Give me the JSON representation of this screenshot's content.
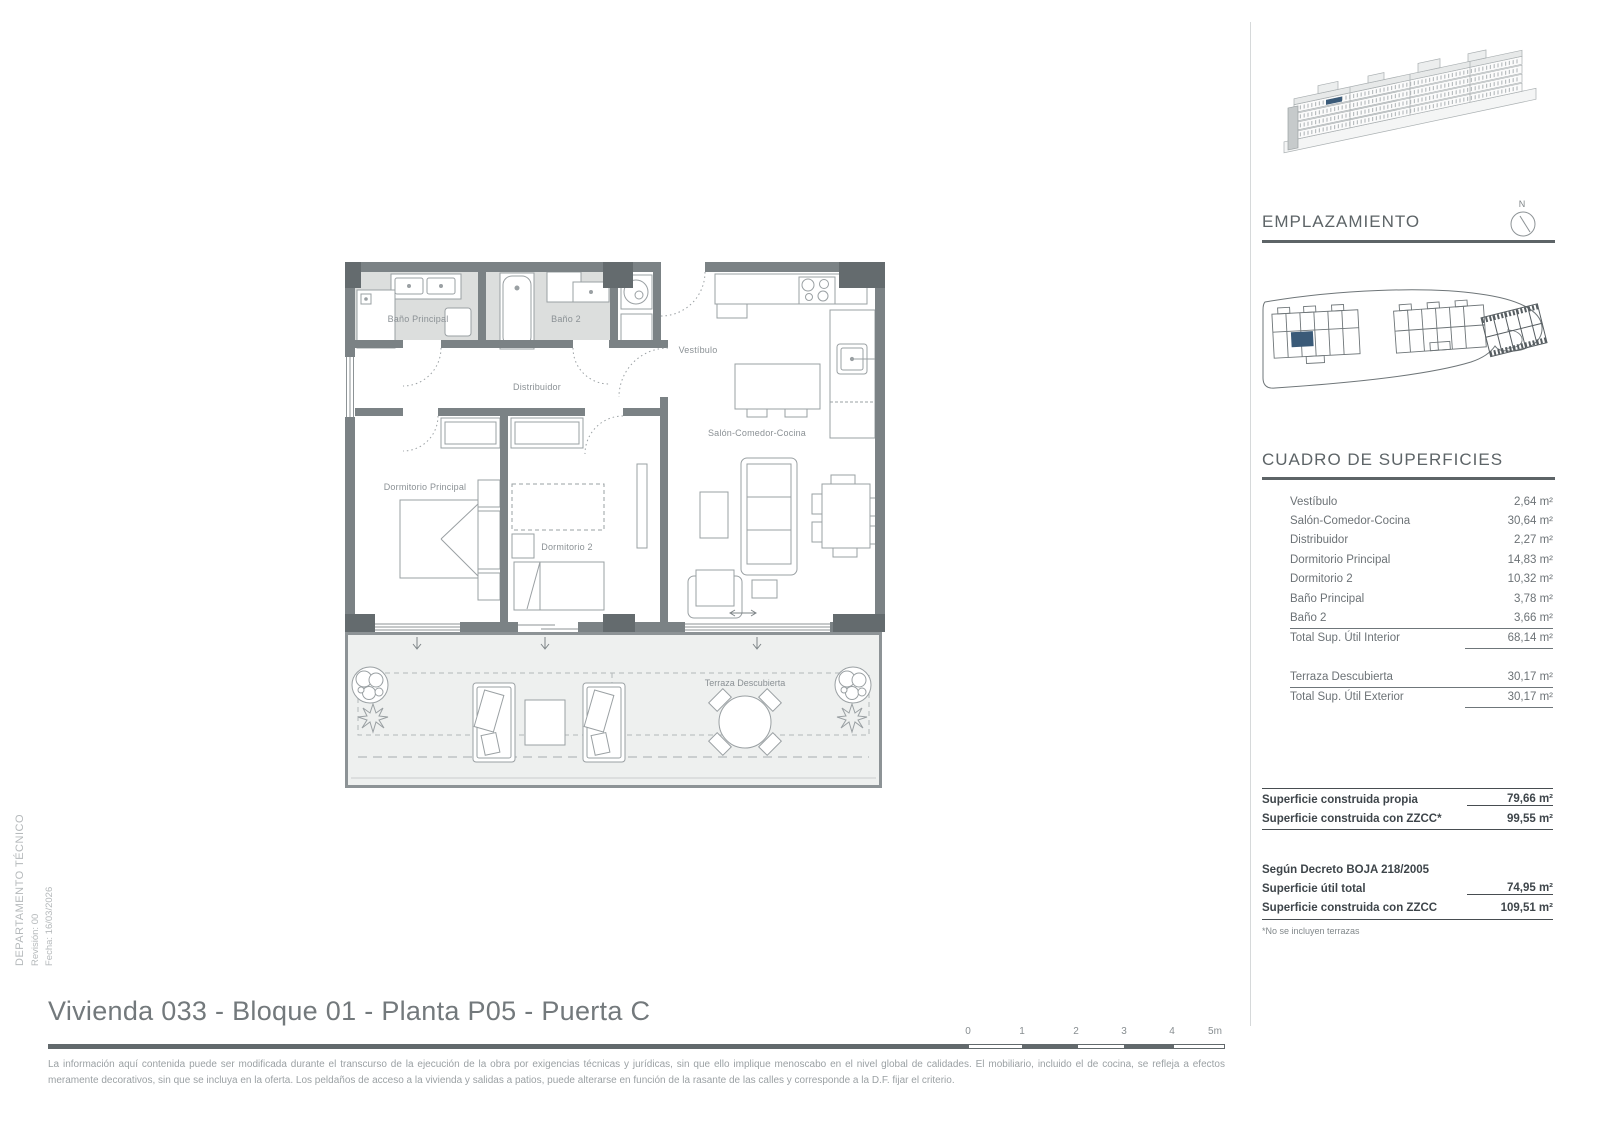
{
  "side_meta": {
    "department": "DEPARTAMENTO TÉCNICO",
    "revision": "Revisión: 00",
    "date": "Fecha: 16/03/2026"
  },
  "plan": {
    "rooms": {
      "bano_principal": "Baño Principal",
      "bano_2": "Baño 2",
      "vestibulo": "Vestíbulo",
      "distribuidor": "Distribuidor",
      "dormitorio_principal": "Dormitorio Principal",
      "dormitorio_2": "Dormitorio 2",
      "salon": "Salón-Comedor-Cocina",
      "terraza": "Terraza Descubierta"
    }
  },
  "sidebar": {
    "emplazamiento_title": "EMPLAZAMIENTO",
    "north_label": "N",
    "surfaces_title": "CUADRO DE SUPERFICIES",
    "rows": [
      {
        "label": "Vestíbulo",
        "value": "2,64 m²"
      },
      {
        "label": "Salón-Comedor-Cocina",
        "value": "30,64 m²"
      },
      {
        "label": "Distribuidor",
        "value": "2,27 m²"
      },
      {
        "label": "Dormitorio Principal",
        "value": "14,83 m²"
      },
      {
        "label": "Dormitorio 2",
        "value": "10,32 m²"
      },
      {
        "label": "Baño Principal",
        "value": "3,78 m²"
      },
      {
        "label": "Baño 2",
        "value": "3,66 m²"
      }
    ],
    "total_interior": {
      "label": "Total Sup. Útil Interior",
      "value": "68,14 m²"
    },
    "terraza_row": {
      "label": "Terraza Descubierta",
      "value": "30,17 m²"
    },
    "total_exterior": {
      "label": "Total Sup. Útil Exterior",
      "value": "30,17 m²"
    },
    "built_rows": [
      {
        "label": "Superficie construida propia",
        "value": "79,66 m²"
      },
      {
        "label": "Superficie construida con ZZCC*",
        "value": "99,55 m²"
      }
    ],
    "decree_title": "Según Decreto BOJA 218/2005",
    "decree_rows": [
      {
        "label": "Superficie útil total",
        "value": "74,95 m²"
      },
      {
        "label": "Superficie construida con ZZCC",
        "value": "109,51 m²"
      }
    ],
    "footnote": "*No se incluyen terrazas"
  },
  "footer": {
    "title": "Vivienda 033 - Bloque 01 - Planta P05 - Puerta C",
    "scale_labels": [
      "0",
      "1",
      "2",
      "3",
      "4",
      "5m"
    ],
    "disclaimer": "La información aquí contenida puede  ser modificada durante el transcurso de la ejecución de la obra por exigencias técnicas y jurídicas,  sin  que  ello  implique  menoscabo  en el nivel global de calidades.  El  mobiliario, incluido el de cocina, se refleja a efectos meramente decorativos, sin que se incluya en la oferta. Los peldaños de acceso a la vivienda y  salidas  a patios,  puede alterarse  en función de la rasante de las calles y corresponde a  la  D.F.  fijar el criterio."
  },
  "colors": {
    "wall": "#7b8285",
    "column": "#646b6e",
    "bath_floor": "#dcdedd",
    "terrace_floor": "#eef0ef",
    "highlight": "#3a5a78",
    "heading": "#5d6467"
  }
}
